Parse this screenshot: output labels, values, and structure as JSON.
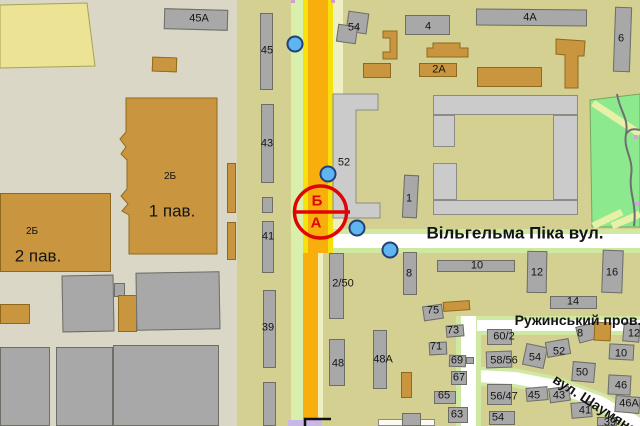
{
  "map_name": "city-street-map",
  "colors": {
    "background": "#D4D091",
    "left_district": "#DBD7C6",
    "road_orange": "#F8AE0C",
    "road_yellow_line": "#F6E20A",
    "verge_green": "#D9EFAC",
    "verge_yellow": "#EFEFC4",
    "street_white": "#FFFFFF",
    "street_casing": "#CFE8A2",
    "building_gray": "#A8A8A8",
    "building_light_gray": "#CBCBCB",
    "building_tan": "#C9963F",
    "building_yellow": "#EDE394",
    "park_green": "#8DE98D",
    "park_path": "#E6F0A6",
    "park_stream": "#6F6F6F",
    "marker_blue": "#5FB5EF",
    "marker_outline": "#223F7A",
    "selection_red": "#E00505",
    "label_text": "#141414",
    "lavender": "#C9B7E6",
    "pink_mark": "#D79AD8"
  },
  "streets": [
    {
      "name": "Вільгельма Піка вул."
    },
    {
      "name": "Ружинський пров."
    },
    {
      "name": "вул. Шаумяна"
    }
  ],
  "selection_marker": {
    "cx": 320.5,
    "cy": 212,
    "r": 26,
    "line": {
      "x1": 294,
      "y1": 212,
      "x2": 350,
      "y2": 212
    },
    "label_top": "Б",
    "label_bottom": "А"
  },
  "markers": [
    {
      "x": 295,
      "y": 44
    },
    {
      "x": 328,
      "y": 174
    },
    {
      "x": 357,
      "y": 228
    },
    {
      "x": 390,
      "y": 250
    }
  ],
  "polygons": [
    {
      "t": "yellow",
      "pts": "0,5 87,3 95,66 0,68"
    },
    {
      "t": "tan",
      "pts": "126,98 217,98 217,254 129,254 129,215 122,211 128,204 121,196 127,189 127,160 121,154 126,147 120,139 126,132"
    },
    {
      "t": "tan",
      "pts": "383,31 397,31 397,59 383,59 383,52 390,52 390,38 383,38"
    },
    {
      "t": "tan",
      "pts": "427,48 433,48 433,43 460,43 460,48 468,48 468,57 427,57"
    },
    {
      "t": "tan",
      "pts": "556,39 585,41 584,56 578,56 578,88 565,88 565,55 556,54"
    },
    {
      "t": "grayL",
      "pts": "333,94 378,94 378,110 356,110 356,203 380,203 380,218 333,218"
    }
  ],
  "buildings": [
    {
      "x": 164,
      "y": 9,
      "w": 64,
      "h": 21,
      "rot": 1.5,
      "t": "gray"
    },
    {
      "x": 152,
      "y": 57,
      "w": 25,
      "h": 15,
      "rot": 2,
      "t": "tan"
    },
    {
      "x": 0,
      "y": 193,
      "w": 111,
      "h": 79,
      "t": "tan"
    },
    {
      "x": 227,
      "y": 163,
      "w": 9,
      "h": 50,
      "t": "tan"
    },
    {
      "x": 227,
      "y": 222,
      "w": 9,
      "h": 38,
      "t": "tan"
    },
    {
      "x": 0,
      "y": 304,
      "w": 30,
      "h": 20,
      "t": "tan"
    },
    {
      "x": 62,
      "y": 275,
      "w": 52,
      "h": 57,
      "rot": -1,
      "t": "gray"
    },
    {
      "x": 114,
      "y": 283,
      "w": 11,
      "h": 14,
      "t": "gray"
    },
    {
      "x": 118,
      "y": 295,
      "w": 19,
      "h": 37,
      "t": "tan"
    },
    {
      "x": 136,
      "y": 272,
      "w": 84,
      "h": 58,
      "rot": -1,
      "t": "gray"
    },
    {
      "x": 0,
      "y": 347,
      "w": 50,
      "h": 79,
      "t": "gray"
    },
    {
      "x": 56,
      "y": 347,
      "w": 57,
      "h": 79,
      "t": "gray"
    },
    {
      "x": 113,
      "y": 345,
      "w": 106,
      "h": 81,
      "t": "gray"
    },
    {
      "x": 260,
      "y": 13,
      "w": 13,
      "h": 77,
      "t": "gray"
    },
    {
      "x": 261,
      "y": 104,
      "w": 13,
      "h": 79,
      "t": "gray"
    },
    {
      "x": 262,
      "y": 197,
      "w": 11,
      "h": 16,
      "t": "gray"
    },
    {
      "x": 262,
      "y": 221,
      "w": 12,
      "h": 52,
      "t": "gray"
    },
    {
      "x": 263,
      "y": 290,
      "w": 13,
      "h": 78,
      "t": "gray"
    },
    {
      "x": 263,
      "y": 382,
      "w": 13,
      "h": 44,
      "t": "gray"
    },
    {
      "x": 347,
      "y": 12,
      "w": 21,
      "h": 21,
      "rot": 8,
      "t": "gray"
    },
    {
      "x": 337,
      "y": 25,
      "w": 20,
      "h": 18,
      "rot": 8,
      "t": "gray"
    },
    {
      "x": 405,
      "y": 15,
      "w": 45,
      "h": 20,
      "t": "gray"
    },
    {
      "x": 476,
      "y": 9,
      "w": 111,
      "h": 17,
      "rot": 0.5,
      "t": "gray"
    },
    {
      "x": 614,
      "y": 7,
      "w": 17,
      "h": 65,
      "rot": 2,
      "t": "gray"
    },
    {
      "x": 363,
      "y": 63,
      "w": 28,
      "h": 15,
      "t": "tan"
    },
    {
      "x": 419,
      "y": 63,
      "w": 38,
      "h": 14,
      "t": "tan"
    },
    {
      "x": 477,
      "y": 67,
      "w": 65,
      "h": 20,
      "t": "tan"
    },
    {
      "x": 403,
      "y": 175,
      "w": 15,
      "h": 43,
      "rot": 3,
      "t": "gray"
    },
    {
      "x": 433,
      "y": 95,
      "w": 145,
      "h": 20,
      "t": "grayL"
    },
    {
      "x": 433,
      "y": 115,
      "w": 22,
      "h": 32,
      "t": "grayL"
    },
    {
      "x": 433,
      "y": 163,
      "w": 24,
      "h": 37,
      "t": "grayL"
    },
    {
      "x": 553,
      "y": 115,
      "w": 25,
      "h": 85,
      "t": "grayL"
    },
    {
      "x": 433,
      "y": 200,
      "w": 145,
      "h": 15,
      "t": "grayL"
    },
    {
      "x": 329,
      "y": 253,
      "w": 15,
      "h": 66,
      "t": "gray"
    },
    {
      "x": 403,
      "y": 252,
      "w": 14,
      "h": 43,
      "t": "gray"
    },
    {
      "x": 437,
      "y": 260,
      "w": 78,
      "h": 12,
      "t": "gray"
    },
    {
      "x": 527,
      "y": 251,
      "w": 20,
      "h": 42,
      "rot": 1,
      "t": "gray"
    },
    {
      "x": 602,
      "y": 250,
      "w": 21,
      "h": 43,
      "rot": 2,
      "t": "gray"
    },
    {
      "x": 550,
      "y": 296,
      "w": 47,
      "h": 13,
      "t": "gray"
    },
    {
      "x": 329,
      "y": 339,
      "w": 16,
      "h": 47,
      "t": "gray"
    },
    {
      "x": 373,
      "y": 330,
      "w": 14,
      "h": 59,
      "t": "gray"
    },
    {
      "x": 401,
      "y": 372,
      "w": 11,
      "h": 26,
      "t": "tan"
    },
    {
      "x": 423,
      "y": 305,
      "w": 20,
      "h": 15,
      "rot": -8,
      "t": "gray"
    },
    {
      "x": 443,
      "y": 301,
      "w": 27,
      "h": 10,
      "rot": -4,
      "t": "tan"
    },
    {
      "x": 446,
      "y": 325,
      "w": 18,
      "h": 12,
      "rot": -5,
      "t": "gray"
    },
    {
      "x": 429,
      "y": 342,
      "w": 18,
      "h": 13,
      "rot": -3,
      "t": "gray"
    },
    {
      "x": 449,
      "y": 355,
      "w": 17,
      "h": 12,
      "rot": 2,
      "t": "gray"
    },
    {
      "x": 466,
      "y": 357,
      "w": 8,
      "h": 7,
      "t": "gray"
    },
    {
      "x": 451,
      "y": 371,
      "w": 16,
      "h": 14,
      "t": "gray"
    },
    {
      "x": 434,
      "y": 391,
      "w": 22,
      "h": 13,
      "t": "gray"
    },
    {
      "x": 378,
      "y": 419,
      "w": 57,
      "h": 7,
      "t": "white"
    },
    {
      "x": 402,
      "y": 413,
      "w": 19,
      "h": 13,
      "t": "gray"
    },
    {
      "x": 448,
      "y": 407,
      "w": 20,
      "h": 16,
      "t": "gray"
    },
    {
      "x": 487,
      "y": 329,
      "w": 25,
      "h": 16,
      "t": "gray"
    },
    {
      "x": 486,
      "y": 351,
      "w": 26,
      "h": 17,
      "rot": -2,
      "t": "gray"
    },
    {
      "x": 487,
      "y": 384,
      "w": 25,
      "h": 21,
      "t": "gray"
    },
    {
      "x": 489,
      "y": 411,
      "w": 26,
      "h": 14,
      "t": "gray"
    },
    {
      "x": 524,
      "y": 345,
      "w": 22,
      "h": 22,
      "rot": 12,
      "t": "gray"
    },
    {
      "x": 546,
      "y": 340,
      "w": 24,
      "h": 16,
      "rot": -10,
      "t": "gray"
    },
    {
      "x": 577,
      "y": 324,
      "w": 22,
      "h": 17,
      "rot": -15,
      "t": "gray"
    },
    {
      "x": 594,
      "y": 322,
      "w": 17,
      "h": 19,
      "rot": 3,
      "t": "tan"
    },
    {
      "x": 572,
      "y": 362,
      "w": 23,
      "h": 20,
      "rot": 5,
      "t": "gray"
    },
    {
      "x": 526,
      "y": 387,
      "w": 22,
      "h": 14,
      "rot": -5,
      "t": "gray"
    },
    {
      "x": 549,
      "y": 387,
      "w": 21,
      "h": 15,
      "rot": -8,
      "t": "gray"
    },
    {
      "x": 571,
      "y": 402,
      "w": 21,
      "h": 16,
      "rot": -5,
      "t": "gray"
    },
    {
      "x": 597,
      "y": 417,
      "w": 20,
      "h": 9,
      "t": "gray"
    },
    {
      "x": 623,
      "y": 323,
      "w": 17,
      "h": 19,
      "rot": 5,
      "t": "gray"
    },
    {
      "x": 609,
      "y": 344,
      "w": 25,
      "h": 16,
      "rot": 3,
      "t": "gray"
    },
    {
      "x": 608,
      "y": 375,
      "w": 23,
      "h": 20,
      "rot": 3,
      "t": "gray"
    },
    {
      "x": 615,
      "y": 396,
      "w": 25,
      "h": 17,
      "rot": 5,
      "t": "gray"
    }
  ],
  "labels": [
    {
      "t": "Вільгельма Піка вул.",
      "x": 515,
      "y": 233,
      "s": 17,
      "b": 1,
      "k": "street"
    },
    {
      "t": "Ружинський пров.",
      "x": 578,
      "y": 320,
      "s": 14,
      "b": 1,
      "k": "street"
    },
    {
      "t": "вул. Шаумяна",
      "x": 595,
      "y": 404,
      "s": 14,
      "b": 1,
      "r": 33,
      "k": "street"
    },
    {
      "t": "Б",
      "x": 317,
      "y": 201,
      "s": 15,
      "c": "red",
      "k": "selection"
    },
    {
      "t": "А",
      "x": 316,
      "y": 223,
      "s": 15,
      "c": "red",
      "k": "selection"
    },
    {
      "t": "45А",
      "x": 199,
      "y": 19
    },
    {
      "t": "2Б",
      "x": 170,
      "y": 177,
      "s": 10
    },
    {
      "t": "1 пав.",
      "x": 172,
      "y": 211,
      "s": 17
    },
    {
      "t": "2Б",
      "x": 32,
      "y": 232,
      "s": 10
    },
    {
      "t": "2 пав.",
      "x": 38,
      "y": 256,
      "s": 17
    },
    {
      "t": "45",
      "x": 267,
      "y": 51
    },
    {
      "t": "43",
      "x": 267,
      "y": 144
    },
    {
      "t": "41",
      "x": 268,
      "y": 237
    },
    {
      "t": "39",
      "x": 268,
      "y": 328
    },
    {
      "t": "54",
      "x": 354,
      "y": 28
    },
    {
      "t": "4",
      "x": 428,
      "y": 27
    },
    {
      "t": "4А",
      "x": 530,
      "y": 18
    },
    {
      "t": "2А",
      "x": 439,
      "y": 70
    },
    {
      "t": "6",
      "x": 621,
      "y": 39
    },
    {
      "t": "52",
      "x": 344,
      "y": 163
    },
    {
      "t": "1",
      "x": 409,
      "y": 199
    },
    {
      "t": "2/50",
      "x": 343,
      "y": 284
    },
    {
      "t": "8",
      "x": 409,
      "y": 274
    },
    {
      "t": "10",
      "x": 477,
      "y": 266
    },
    {
      "t": "12",
      "x": 537,
      "y": 273
    },
    {
      "t": "16",
      "x": 612,
      "y": 273
    },
    {
      "t": "14",
      "x": 573,
      "y": 302
    },
    {
      "t": "48",
      "x": 338,
      "y": 364
    },
    {
      "t": "48А",
      "x": 383,
      "y": 360
    },
    {
      "t": "75",
      "x": 433,
      "y": 311
    },
    {
      "t": "73",
      "x": 453,
      "y": 331
    },
    {
      "t": "71",
      "x": 436,
      "y": 347
    },
    {
      "t": "69",
      "x": 457,
      "y": 361
    },
    {
      "t": "67",
      "x": 459,
      "y": 378
    },
    {
      "t": "65",
      "x": 444,
      "y": 396
    },
    {
      "t": "63",
      "x": 457,
      "y": 415
    },
    {
      "t": "60/2",
      "x": 504,
      "y": 337
    },
    {
      "t": "58/56",
      "x": 504,
      "y": 361
    },
    {
      "t": "56/47",
      "x": 504,
      "y": 397
    },
    {
      "t": "54",
      "x": 498,
      "y": 418
    },
    {
      "t": "54",
      "x": 535,
      "y": 358
    },
    {
      "t": "52",
      "x": 559,
      "y": 352
    },
    {
      "t": "8",
      "x": 580,
      "y": 334
    },
    {
      "t": "50",
      "x": 582,
      "y": 373
    },
    {
      "t": "45",
      "x": 534,
      "y": 396
    },
    {
      "t": "43",
      "x": 559,
      "y": 396
    },
    {
      "t": "41",
      "x": 585,
      "y": 411
    },
    {
      "t": "39",
      "x": 610,
      "y": 423
    },
    {
      "t": "12",
      "x": 634,
      "y": 334
    },
    {
      "t": "10",
      "x": 621,
      "y": 354
    },
    {
      "t": "46",
      "x": 621,
      "y": 386
    },
    {
      "t": "46А",
      "x": 629,
      "y": 404
    }
  ]
}
